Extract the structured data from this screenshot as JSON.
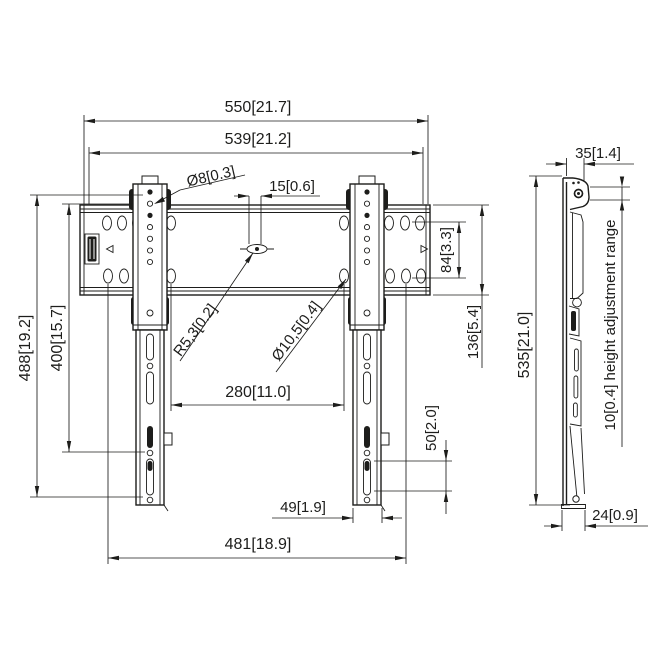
{
  "drawing_title": "Wall mount dimensional drawing",
  "front_view": {
    "dim_overall_width": "550[21.7]",
    "dim_rail_width": "539[21.2]",
    "label_hole_dia": "Ø8[0.3]",
    "dim_slot_width": "15[0.6]",
    "dim_hole_rows": "84[3.3]",
    "dim_rail_height": "136[5.4]",
    "label_radius": "R5,3[0.2]",
    "label_hole_dia_large": "Ø10,5[0.4]",
    "dim_inner_hole_span": "280[11.0]",
    "dim_slot_pitch": "50[2.0]",
    "dim_bracket_width": "49[1.9]",
    "dim_outer_hole_span": "481[18.9]",
    "dim_total_height": "488[19.2]",
    "dim_vesa_height": "400[15.7]"
  },
  "side_view": {
    "dim_top_depth": "35[1.4]",
    "dim_height": "535[21.0]",
    "label_height_adjustment": "10[0.4] height adjustment range",
    "dim_bottom_depth": "24[0.9]"
  },
  "colors": {
    "line": "#1d1d1b",
    "background": "#ffffff"
  }
}
